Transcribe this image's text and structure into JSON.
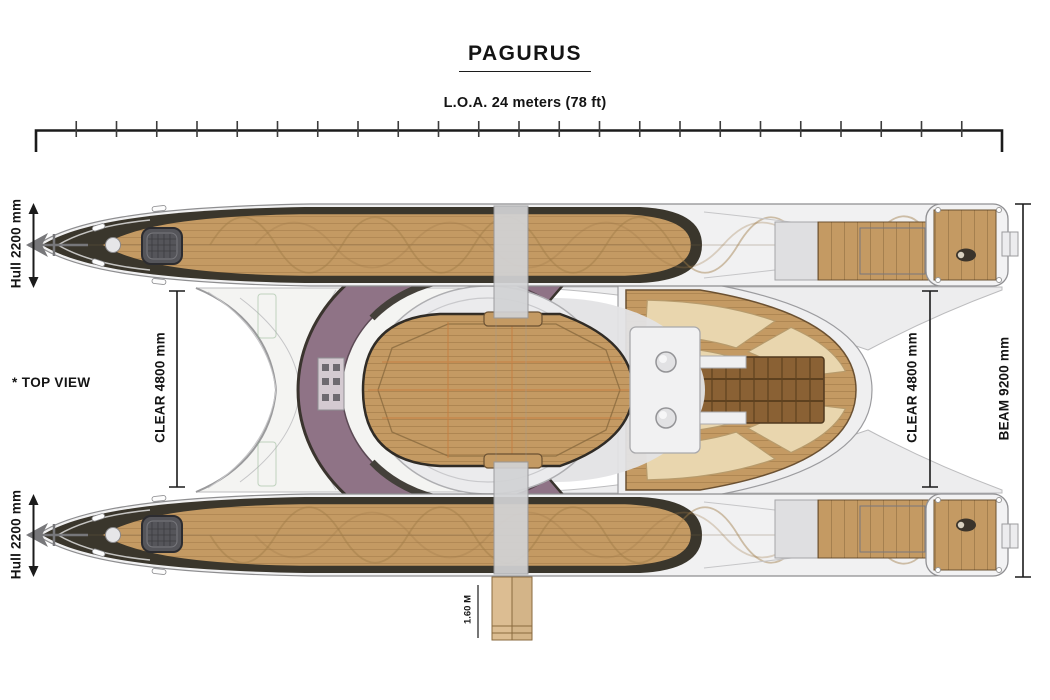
{
  "title": "PAGURUS",
  "view_note": "* TOP VIEW",
  "labels": {
    "loa": "L.O.A. 24 meters (78 ft)",
    "hull_top": "Hull 2200 mm",
    "hull_bottom": "Hull 2200 mm",
    "clear_left": "CLEAR 4800 mm",
    "clear_right": "CLEAR 4800 mm",
    "beam": "BEAM 9200 mm",
    "gangway": "1.60 M"
  },
  "dimensions": {
    "loa_m": 24,
    "loa_ft": 78,
    "hull_beam_mm": 2200,
    "clear_between_hulls_mm": 4800,
    "beam_overall_mm": 9200,
    "gangway_m": 1.6,
    "ruler_tick_count": 23
  },
  "drawing": {
    "subject": "catamaran top view plan",
    "icons": [
      "anchor-icon",
      "helm-figure-icon",
      "hatch-icon",
      "windlass-icon"
    ]
  },
  "colors": {
    "teak": "#c49a63",
    "teak_light": "#e8d2a8",
    "deck_dark": "#8a6134",
    "hull_dark": "#3a362c",
    "mauve": "#8f7386",
    "silver": "#f1f1f2",
    "pad": "#e9d6ae",
    "ink": "#1a1a1a"
  }
}
